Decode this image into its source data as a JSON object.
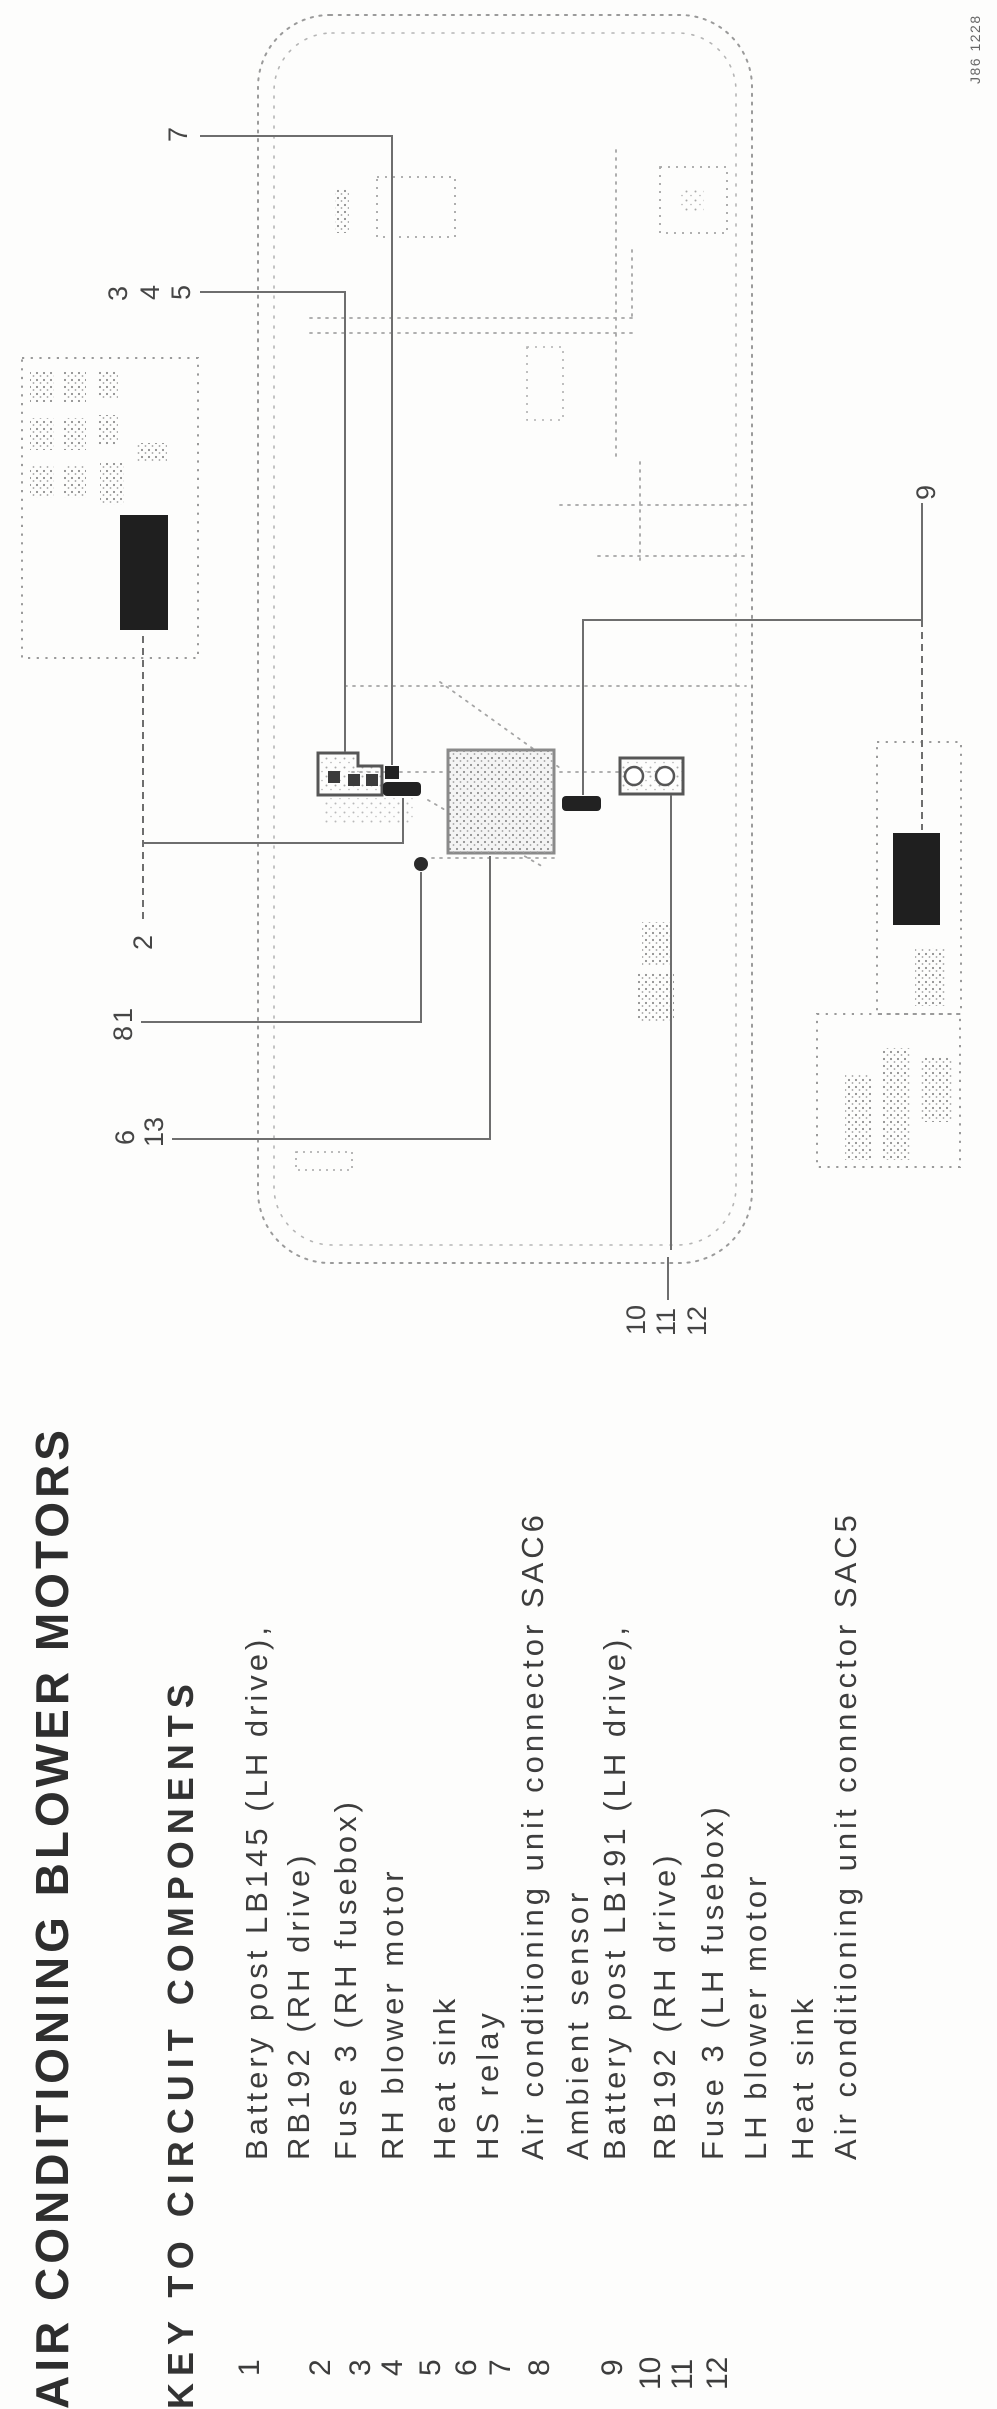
{
  "page": {
    "title": "AIR CONDITIONING BLOWER MOTORS",
    "subtitle": "KEY TO CIRCUIT COMPONENTS",
    "figure_code": "J86 1228"
  },
  "key": {
    "items": [
      {
        "num": "1",
        "lines": [
          "Battery post LB145 (LH drive),",
          "RB192 (RH drive)"
        ]
      },
      {
        "num": "2",
        "lines": [
          "Fuse 3 (RH fusebox)"
        ]
      },
      {
        "num": "3",
        "lines": [
          "RH blower motor"
        ]
      },
      {
        "num": "4",
        "lines": [
          "Heat sink"
        ]
      },
      {
        "num": "5",
        "lines": [
          "HS relay"
        ]
      },
      {
        "num": "6",
        "lines": [
          "Air conditioning unit connector SAC6"
        ]
      },
      {
        "num": "7",
        "lines": [
          "Ambient sensor"
        ]
      },
      {
        "num": "8",
        "lines": [
          "Battery post LB191 (LH drive),",
          "RB192 (RH drive)"
        ]
      },
      {
        "num": "9",
        "lines": [
          "Fuse 3 (LH fusebox)"
        ]
      },
      {
        "num": "10",
        "lines": [
          "LH blower motor"
        ]
      },
      {
        "num": "11",
        "lines": [
          "Heat sink"
        ]
      },
      {
        "num": "12",
        "lines": [
          "Air conditioning unit connector SAC5"
        ]
      }
    ]
  },
  "diagram": {
    "callouts": [
      "7",
      "3",
      "4",
      "5",
      "2",
      "1",
      "8",
      "6",
      "13",
      "9",
      "10",
      "11",
      "12"
    ],
    "colors": {
      "component_black": "#1f1f1f",
      "dotted_outline_gray": "#9a9a9a",
      "leader_line_gray": "#6e6e6e",
      "unit_fill": "#f4f4f4"
    }
  }
}
